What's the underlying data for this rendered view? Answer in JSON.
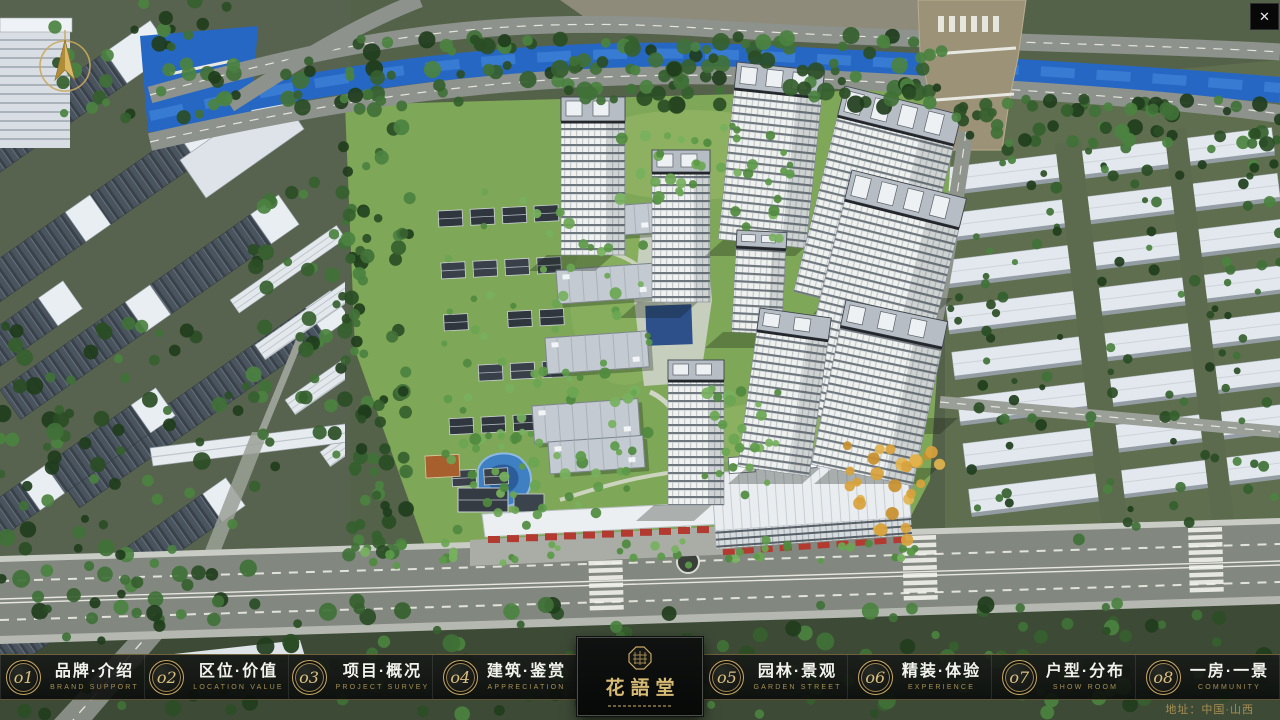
{
  "chrome": {
    "close_glyph": "✕"
  },
  "nav": {
    "items": [
      {
        "num": "o1",
        "cn": "品牌·介绍",
        "en": "BRAND SUPPORT"
      },
      {
        "num": "o2",
        "cn": "区位·价值",
        "en": "LOCATION VALUE"
      },
      {
        "num": "o3",
        "cn": "项目·概况",
        "en": "PROJECT SURVEY"
      },
      {
        "num": "o4",
        "cn": "建筑·鉴赏",
        "en": "APPRECIATION"
      },
      {
        "num": "o5",
        "cn": "园林·景观",
        "en": "GARDEN STREET"
      },
      {
        "num": "o6",
        "cn": "精装·体验",
        "en": "EXPERIENCE"
      },
      {
        "num": "o7",
        "cn": "户型·分布",
        "en": "SHOW ROOM"
      },
      {
        "num": "o8",
        "cn": "一房·一景",
        "en": "COMMUNITY"
      }
    ]
  },
  "logo": {
    "title": "花語堂"
  },
  "footer": {
    "address": "地址：中国·山西"
  },
  "colors": {
    "gold": "#c9a763",
    "bar_bg": "#10120f",
    "water": "#2667c4",
    "grass": "#7ea757"
  }
}
